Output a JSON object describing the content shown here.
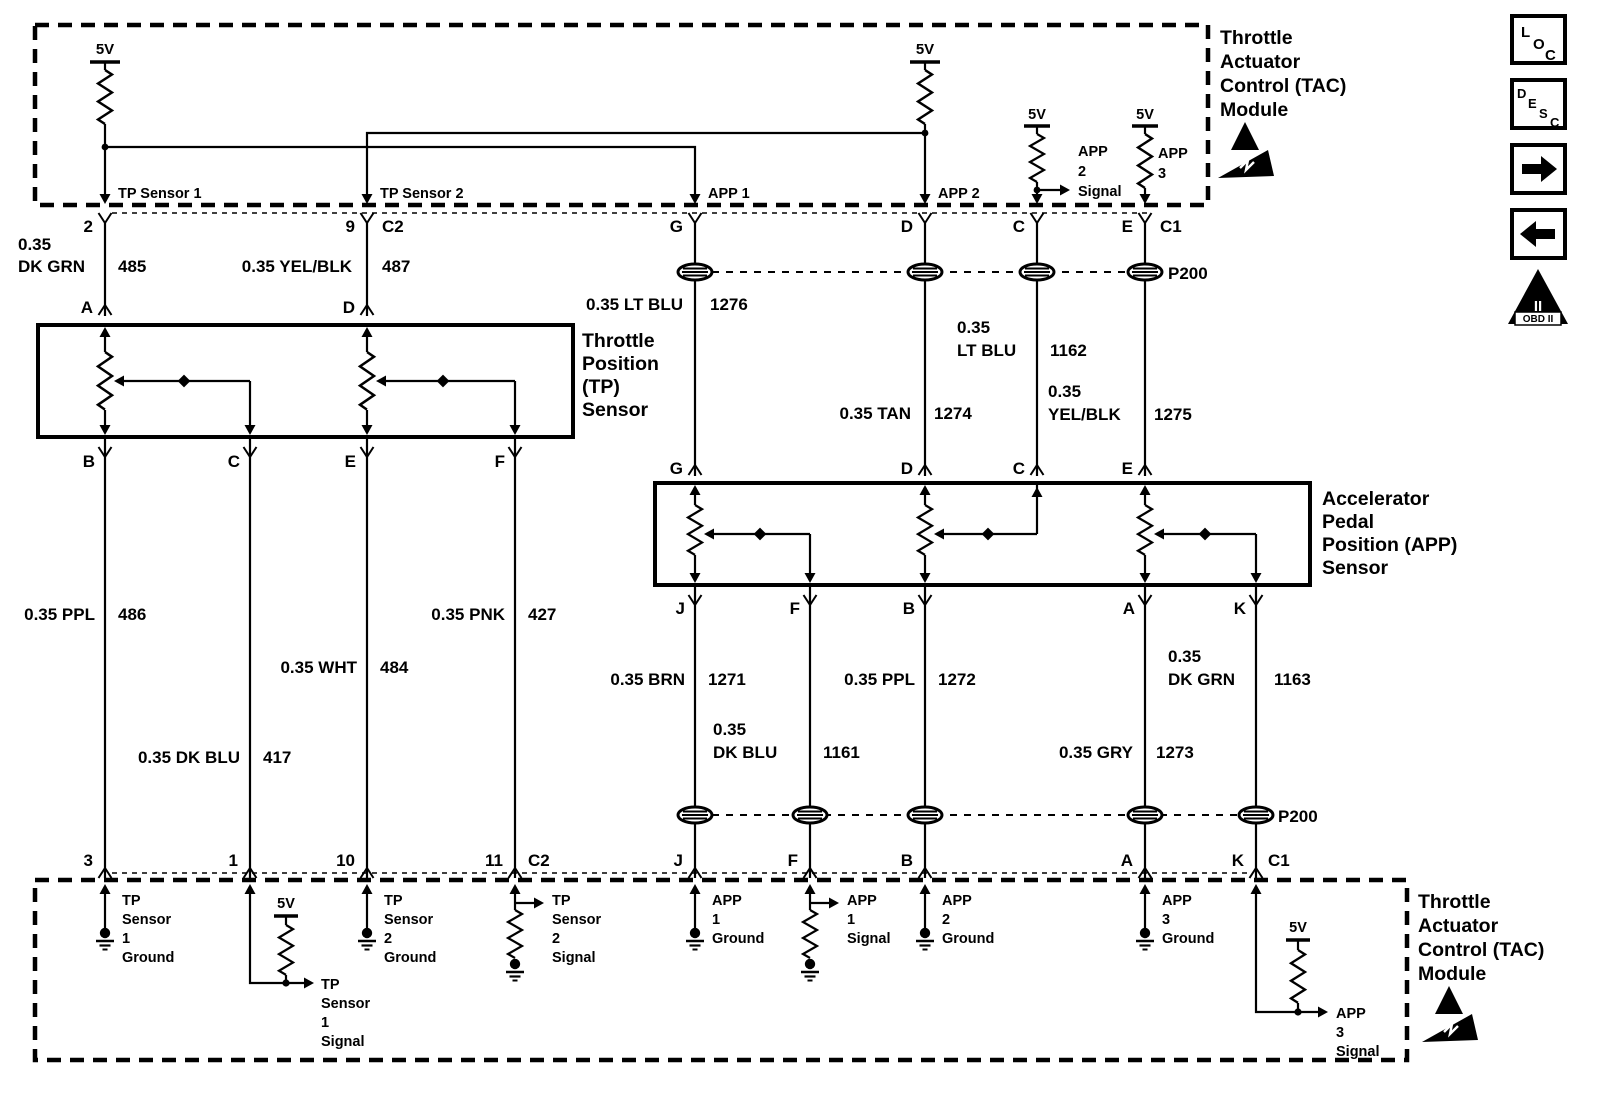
{
  "power": "5V",
  "connector_name": "P200",
  "modules": {
    "tac": [
      "Throttle",
      "Actuator",
      "Control (TAC)",
      "Module"
    ]
  },
  "sensors": {
    "tp": [
      "Throttle",
      "Position",
      "(TP)",
      "Sensor"
    ],
    "app": [
      "Accelerator",
      "Pedal",
      "Position (APP)",
      "Sensor"
    ]
  },
  "pins": {
    "p2": "2",
    "p9": "9",
    "c2": "C2",
    "g": "G",
    "d": "D",
    "c": "C",
    "e": "E",
    "c1": "C1",
    "a": "A",
    "b": "B",
    "f": "F",
    "j": "J",
    "k": "K",
    "p3": "3",
    "p1": "1",
    "p10": "10",
    "p11": "11"
  },
  "top_labels": {
    "tp1": "TP Sensor 1",
    "tp2": "TP Sensor 2",
    "app1": "APP 1",
    "app2": "APP 2",
    "app2sig": [
      "APP",
      "2",
      "Signal"
    ],
    "app3": [
      "APP",
      "3"
    ]
  },
  "wires": {
    "w485": {
      "l1": "0.35",
      "l2": "DK GRN",
      "ckt": "485"
    },
    "w487": {
      "l1": "0.35 YEL/BLK",
      "ckt": "487"
    },
    "w1276": {
      "l1": "0.35 LT BLU",
      "ckt": "1276"
    },
    "w1162": {
      "l1": "0.35",
      "l2": "LT BLU",
      "ckt": "1162"
    },
    "w1274": {
      "l1": "0.35 TAN",
      "ckt": "1274"
    },
    "w1275": {
      "l1": "0.35",
      "l2": "YEL/BLK",
      "ckt": "1275"
    },
    "w486": {
      "l1": "0.35 PPL",
      "ckt": "486"
    },
    "w484": {
      "l1": "0.35 WHT",
      "ckt": "484"
    },
    "w417": {
      "l1": "0.35 DK BLU",
      "ckt": "417"
    },
    "w427": {
      "l1": "0.35 PNK",
      "ckt": "427"
    },
    "w1271": {
      "l1": "0.35 BRN",
      "ckt": "1271"
    },
    "w1272": {
      "l1": "0.35 PPL",
      "ckt": "1272"
    },
    "w1163": {
      "l1": "0.35",
      "l2": "DK GRN",
      "ckt": "1163"
    },
    "w1161": {
      "l1": "0.35",
      "l2": "DK BLU",
      "ckt": "1161"
    },
    "w1273": {
      "l1": "0.35 GRY",
      "ckt": "1273"
    }
  },
  "bottom_labels": {
    "tp1g": [
      "TP",
      "Sensor",
      "1",
      "Ground"
    ],
    "tp1s": [
      "TP",
      "Sensor",
      "1",
      "Signal"
    ],
    "tp2g": [
      "TP",
      "Sensor",
      "2",
      "Ground"
    ],
    "tp2s": [
      "TP",
      "Sensor",
      "2",
      "Signal"
    ],
    "app1g": [
      "APP",
      "1",
      "Ground"
    ],
    "app1s": [
      "APP",
      "1",
      "Signal"
    ],
    "app2g": [
      "APP",
      "2",
      "Ground"
    ],
    "app3g": [
      "APP",
      "3",
      "Ground"
    ],
    "app3s": [
      "APP",
      "3",
      "Signal"
    ]
  },
  "side_toolbar": {
    "loc": [
      "L",
      "O",
      "C"
    ],
    "desc": [
      "D",
      "E",
      "S",
      "C"
    ],
    "obd_mark": "II",
    "obd_text": "OBD II"
  }
}
